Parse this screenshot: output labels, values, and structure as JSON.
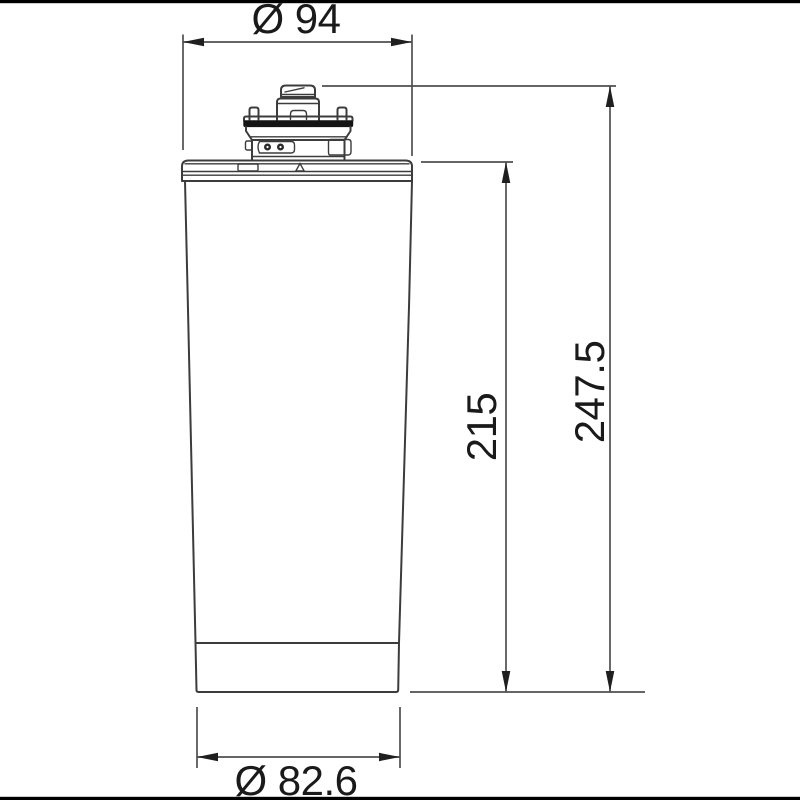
{
  "page": {
    "background": "#ffffff"
  },
  "drawing": {
    "type": "technical-dimension-drawing",
    "subject": "filter-cartridge-side-view",
    "dimensions": {
      "top_diameter": {
        "label": "Ø 94",
        "value": 94
      },
      "body_height": {
        "label": "215",
        "value": 215
      },
      "total_height": {
        "label": "247.5",
        "value": 247.5
      },
      "bottom_diameter": {
        "label": "Ø 82.6",
        "value": 82.6
      }
    },
    "colors": {
      "outline": "#3c3c3c",
      "dimension_lines": "#4f4f4f",
      "arrowheads": "#1f1f1f",
      "text": "#1a1a1a",
      "seal_band": "#141414",
      "border_bar": "#000000",
      "background": "#ffffff"
    }
  }
}
